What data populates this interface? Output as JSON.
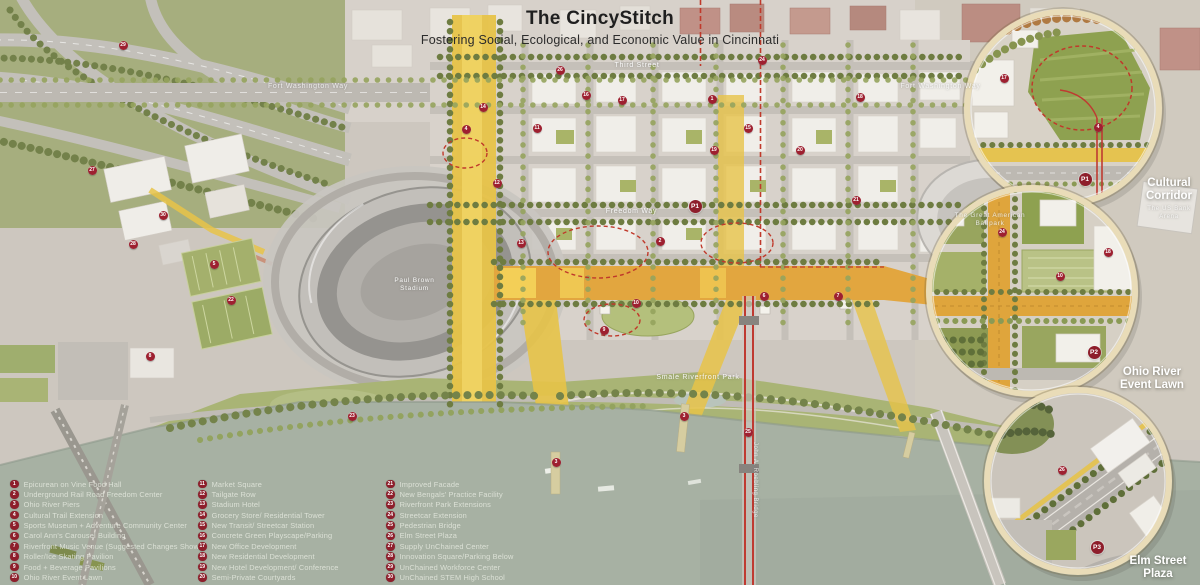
{
  "title": {
    "main": "The CincyStitch",
    "subtitle": "Fostering Social, Ecological, and Economic Value in Cincinnati"
  },
  "map_labels": {
    "third_street": "Third Street",
    "fort_washington_way_left": "Fort Washington Way",
    "fort_washington_way_right": "Fort Washington Way",
    "freedom_way": "Freedom Way",
    "paul_brown_stadium": "Paul Brown\nStadium",
    "smale_riverfront_park": "Smale Riverfront Park",
    "great_american_ballpark": "The Great American\nBallpark",
    "us_bank_arena": "The US Bank\nArena",
    "roebling_bridge": "John A. Roebling Bridge"
  },
  "insets": [
    {
      "name": "cultural-corridor",
      "label": "Cultural\nCorridor"
    },
    {
      "name": "ohio-river-event-lawn",
      "label": "Ohio River\nEvent Lawn"
    },
    {
      "name": "elm-street-plaza",
      "label": "Elm Street\nPlaza"
    }
  ],
  "legend": {
    "columns": [
      {
        "items": [
          {
            "num": "1",
            "label": "Epicurean on Vine Food Hall"
          },
          {
            "num": "2",
            "label": "Underground Rail Road Freedom Center"
          },
          {
            "num": "3",
            "label": "Ohio River Piers"
          },
          {
            "num": "4",
            "label": "Cultural Trail Extension"
          },
          {
            "num": "5",
            "label": "Sports Museum + Adventure Community Center"
          },
          {
            "num": "6",
            "label": "Carol Ann's Carousel Building"
          },
          {
            "num": "7",
            "label": "Riverfront Music Venue (Suggested Changes Shown)"
          },
          {
            "num": "8",
            "label": "Roller/Ice Skating Pavilion"
          },
          {
            "num": "9",
            "label": "Food + Beverage Pavilions"
          },
          {
            "num": "10",
            "label": "Ohio River Event Lawn"
          }
        ]
      },
      {
        "items": [
          {
            "num": "11",
            "label": "Market Square"
          },
          {
            "num": "12",
            "label": "Tailgate Row"
          },
          {
            "num": "13",
            "label": "Stadium Hotel"
          },
          {
            "num": "14",
            "label": "Grocery Store/ Residential Tower"
          },
          {
            "num": "15",
            "label": "New Transit/ Streetcar Station"
          },
          {
            "num": "16",
            "label": "Concrete Green Playscape/Parking"
          },
          {
            "num": "17",
            "label": "New Office Development"
          },
          {
            "num": "18",
            "label": "New Residential Development"
          },
          {
            "num": "19",
            "label": "New Hotel Development/ Conference"
          },
          {
            "num": "20",
            "label": "Semi-Private Courtyards"
          }
        ]
      },
      {
        "items": [
          {
            "num": "21",
            "label": "Improved Facade"
          },
          {
            "num": "22",
            "label": "New Bengals' Practice Facility"
          },
          {
            "num": "23",
            "label": "Riverfront Park Extensions"
          },
          {
            "num": "24",
            "label": "Streetcar Extension"
          },
          {
            "num": "25",
            "label": "Pedestrian Bridge"
          },
          {
            "num": "26",
            "label": "Elm Street Plaza"
          },
          {
            "num": "27",
            "label": "Supply UnChained Center"
          },
          {
            "num": "28",
            "label": "Innovation Square/Parking Below"
          },
          {
            "num": "29",
            "label": "UnChained Workforce Center"
          },
          {
            "num": "30",
            "label": "UnChained STEM High School"
          }
        ]
      }
    ]
  },
  "markers": [
    {
      "n": "29",
      "x": 123,
      "y": 45
    },
    {
      "n": "27",
      "x": 92,
      "y": 170
    },
    {
      "n": "30",
      "x": 163,
      "y": 215
    },
    {
      "n": "28",
      "x": 133,
      "y": 244
    },
    {
      "n": "5",
      "x": 214,
      "y": 264
    },
    {
      "n": "22",
      "x": 231,
      "y": 300
    },
    {
      "n": "8",
      "x": 150,
      "y": 356
    },
    {
      "n": "23",
      "x": 352,
      "y": 416
    },
    {
      "n": "4",
      "x": 466,
      "y": 129
    },
    {
      "n": "14",
      "x": 483,
      "y": 107
    },
    {
      "n": "26",
      "x": 560,
      "y": 70
    },
    {
      "n": "16",
      "x": 586,
      "y": 95
    },
    {
      "n": "17",
      "x": 622,
      "y": 100
    },
    {
      "n": "1",
      "x": 712,
      "y": 99
    },
    {
      "n": "24",
      "x": 762,
      "y": 60
    },
    {
      "n": "18",
      "x": 860,
      "y": 97
    },
    {
      "n": "11",
      "x": 537,
      "y": 128
    },
    {
      "n": "15",
      "x": 748,
      "y": 128
    },
    {
      "n": "19",
      "x": 714,
      "y": 150
    },
    {
      "n": "20",
      "x": 800,
      "y": 150
    },
    {
      "n": "12",
      "x": 497,
      "y": 183
    },
    {
      "n": "21",
      "x": 856,
      "y": 200
    },
    {
      "n": "13",
      "x": 521,
      "y": 243
    },
    {
      "n": "2",
      "x": 660,
      "y": 241
    },
    {
      "n": "10",
      "x": 636,
      "y": 303
    },
    {
      "n": "6",
      "x": 764,
      "y": 296
    },
    {
      "n": "7",
      "x": 838,
      "y": 296
    },
    {
      "n": "9",
      "x": 604,
      "y": 330
    },
    {
      "n": "3",
      "x": 556,
      "y": 462
    },
    {
      "n": "3",
      "x": 684,
      "y": 416
    },
    {
      "n": "25",
      "x": 748,
      "y": 432
    },
    {
      "n": "4",
      "x": 1098,
      "y": 127
    },
    {
      "n": "17",
      "x": 1004,
      "y": 78
    },
    {
      "n": "10",
      "x": 1060,
      "y": 276
    },
    {
      "n": "18",
      "x": 1108,
      "y": 252
    },
    {
      "n": "24",
      "x": 1002,
      "y": 232
    },
    {
      "n": "26",
      "x": 1062,
      "y": 470
    }
  ],
  "p_markers": [
    {
      "label": "P1",
      "x": 695,
      "y": 206
    },
    {
      "label": "P1",
      "x": 1085,
      "y": 179
    },
    {
      "label": "P2",
      "x": 1094,
      "y": 352
    },
    {
      "label": "P3",
      "x": 1097,
      "y": 547
    }
  ],
  "colors": {
    "legend_badge": "#8e1e2b",
    "map_marker": "#9e2030",
    "route_red": "#c0392b",
    "stitch_yellow": "#e7c348",
    "stitch_orange": "#e2a63f",
    "park_green": "#a9b475",
    "river": "#a7b1a3"
  }
}
